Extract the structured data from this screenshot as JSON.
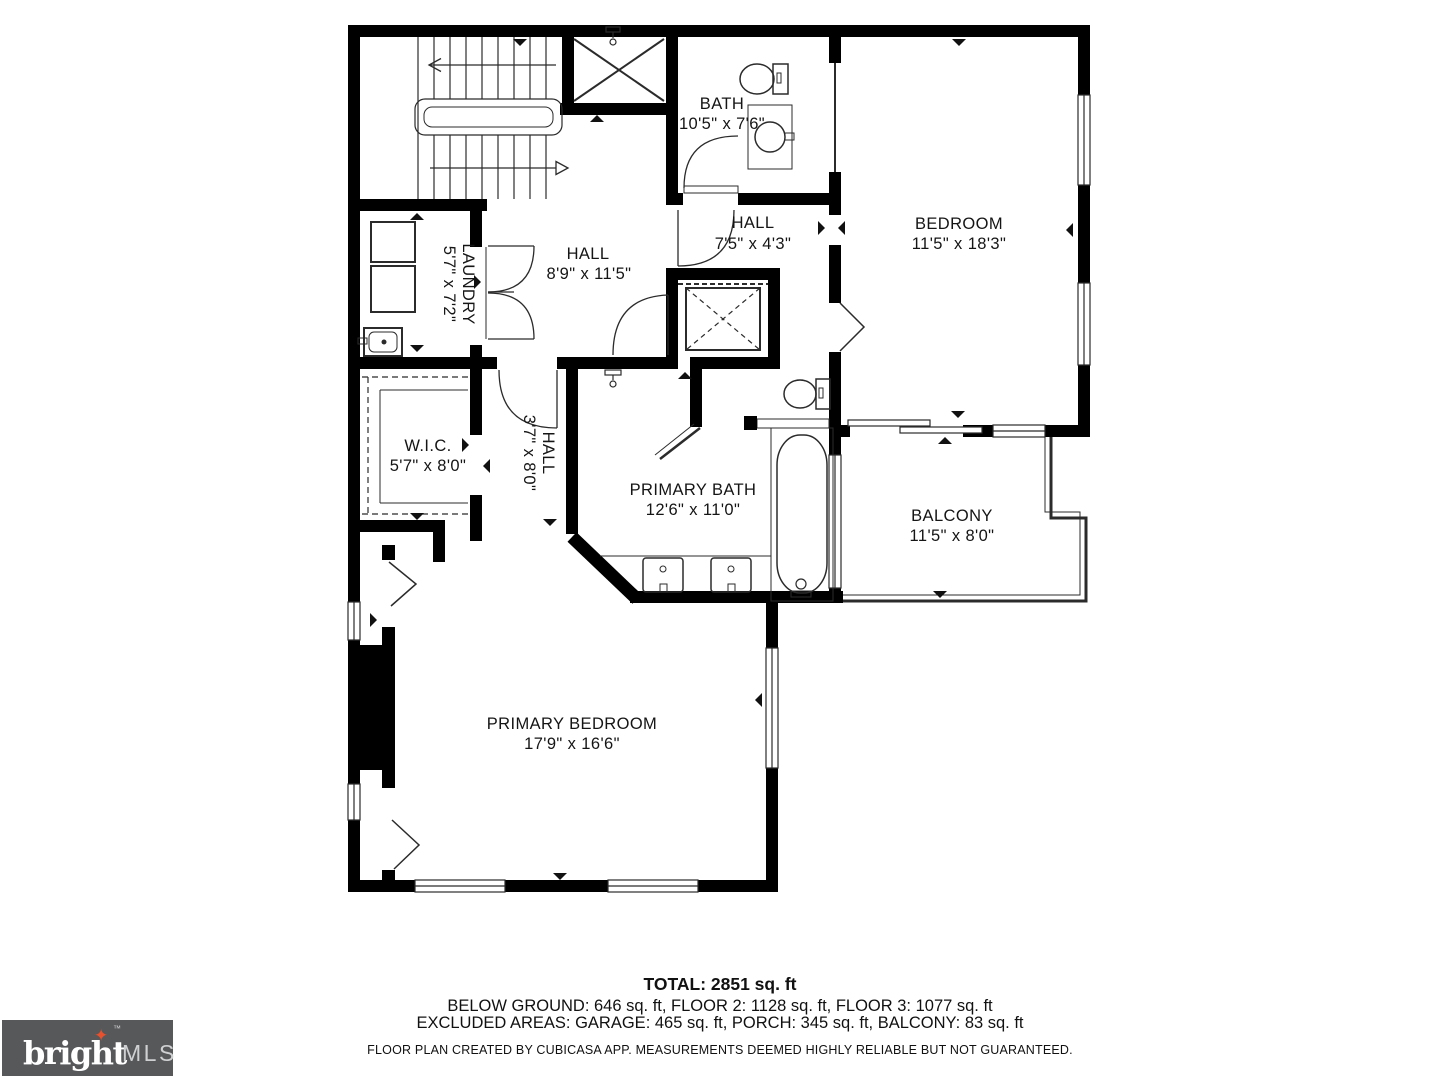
{
  "page": {
    "width": 1440,
    "height": 1080,
    "background": "#ffffff"
  },
  "plan": {
    "rooms": [
      {
        "id": "bath",
        "name": "BATH",
        "dims": "10'5\" x 7'6\""
      },
      {
        "id": "hall-upper",
        "name": "HALL",
        "dims": "7'5\" x 4'3\""
      },
      {
        "id": "bedroom",
        "name": "BEDROOM",
        "dims": "11'5\" x 18'3\""
      },
      {
        "id": "hall-main",
        "name": "HALL",
        "dims": "8'9\" x 11'5\""
      },
      {
        "id": "laundry",
        "name": "LAUNDRY",
        "dims": "5'7\" x 7'2\""
      },
      {
        "id": "wic",
        "name": "W.I.C.",
        "dims": "5'7\" x 8'0\""
      },
      {
        "id": "hall-lower",
        "name": "HALL",
        "dims": "3'7\" x 8'0\""
      },
      {
        "id": "primary-bath",
        "name": "PRIMARY BATH",
        "dims": "12'6\" x 11'0\""
      },
      {
        "id": "balcony",
        "name": "BALCONY",
        "dims": "11'5\" x 8'0\""
      },
      {
        "id": "primary-bedroom",
        "name": "PRIMARY BEDROOM",
        "dims": "17'9\" x 16'6\""
      }
    ]
  },
  "summary": {
    "total": "TOTAL: 2851 sq. ft",
    "floors": "BELOW GROUND: 646 sq. ft, FLOOR 2: 1128 sq. ft, FLOOR 3: 1077 sq. ft",
    "excluded": "EXCLUDED AREAS: GARAGE: 465 sq. ft, PORCH: 345 sq. ft, BALCONY: 83 sq. ft",
    "disclaimer": "FLOOR PLAN CREATED BY CUBICASA APP. MEASUREMENTS DEEMED HIGHLY RELIABLE BUT NOT GUARANTEED."
  },
  "logo": {
    "brand": "bright",
    "tm": "™",
    "suffix": "MLS",
    "star": "✦"
  },
  "colors": {
    "walls": "#000000",
    "fixture_lines": "#2b2b2b",
    "label_text": "#151515",
    "logo_bg": "#57585a",
    "logo_star": "#e8512d",
    "logo_suffix_text": "#ced0d1"
  }
}
